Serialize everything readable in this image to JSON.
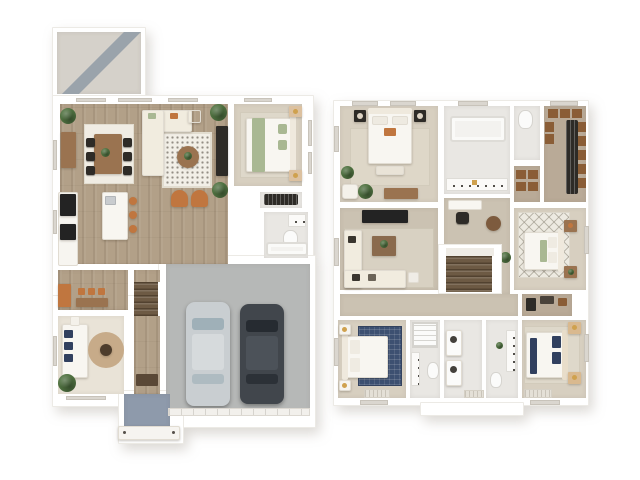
{
  "scene": {
    "description": "3D rendered two-story residential floor plan, top-down view, first floor on the left and second floor on the right, white background, no text labels"
  },
  "palette": {
    "background": "#ffffff",
    "wall_white": "#ffffff",
    "wood_floor": "#b2a088",
    "den_floor": "#e9e3d7",
    "carpet_bedroom": "#d7cfc0",
    "carpet_hall": "#cbc2b2",
    "carpet_closet": "#b9aa97",
    "bath_floor": "#e9e7e3",
    "tile_patio": "#d5d1ca",
    "patio_stripe": "#9aa3ab",
    "garage_concrete": "#b6b8b7",
    "porch_blue": "#8e9aab",
    "stair_wood": "#6d5a44",
    "rug_offwhite": "#f0ece3",
    "rug_tan": "#c7ab89",
    "rug_navy": "#3d5071",
    "bed_white": "#f8f6f1",
    "headboard_cream": "#efe9dd",
    "cream_sofa": "#f1ecdf",
    "wood_furniture": "#9a7350",
    "dark_furniture": "#2e2b27",
    "black_appliance": "#232323",
    "rust_accent": "#c0763f",
    "green_accent": "#a9b893",
    "navy_accent": "#31405f",
    "gold_accent": "#cfa14e",
    "plant_green": "#4f7140",
    "car_silver": "#c9ced1",
    "car_dark": "#41464c",
    "closet_box": "#8a5d36",
    "window_glass": "#dad6cf"
  },
  "first_floor": {
    "rooms": [
      "patio",
      "dining-area",
      "living-area",
      "kitchen",
      "mudroom-pantry",
      "bedroom",
      "closet",
      "bathroom",
      "den-study",
      "entry-hall",
      "staircase",
      "two-car-garage",
      "front-porch"
    ],
    "garage_vehicles": [
      "silver-car",
      "dark-car"
    ],
    "furniture": [
      "dining-table",
      "dining-chairs-x6",
      "sideboard",
      "kitchen-island",
      "bar-stools-x3",
      "refrigerator",
      "range",
      "sectional-sofa",
      "checkered-rug",
      "round-coffee-table",
      "accent-chairs-x2",
      "media-console",
      "bed",
      "nightstands",
      "bathtub",
      "toilet",
      "sink",
      "daybed",
      "round-rug",
      "plants"
    ]
  },
  "second_floor": {
    "rooms": [
      "primary-bedroom",
      "loft",
      "primary-bathroom",
      "water-closet",
      "walk-in-closet",
      "linen-closet",
      "bedroom-2",
      "bedroom-3",
      "bedroom-4",
      "hall-bathroom",
      "laundry",
      "back-bathroom",
      "hallway",
      "staircase"
    ],
    "furniture": [
      "primary-bed",
      "dark-nightstands",
      "bench",
      "armchair",
      "sectional-sofa",
      "media-console",
      "coffee-table",
      "bathtub",
      "double-vanity",
      "toilets",
      "desk-nook",
      "pouf",
      "closet-shelves",
      "hanging-clothes",
      "trellis-rug-bed",
      "navy-rug-bed",
      "navy-pillow-bed",
      "washer-dryer",
      "door-mats",
      "plants"
    ]
  }
}
